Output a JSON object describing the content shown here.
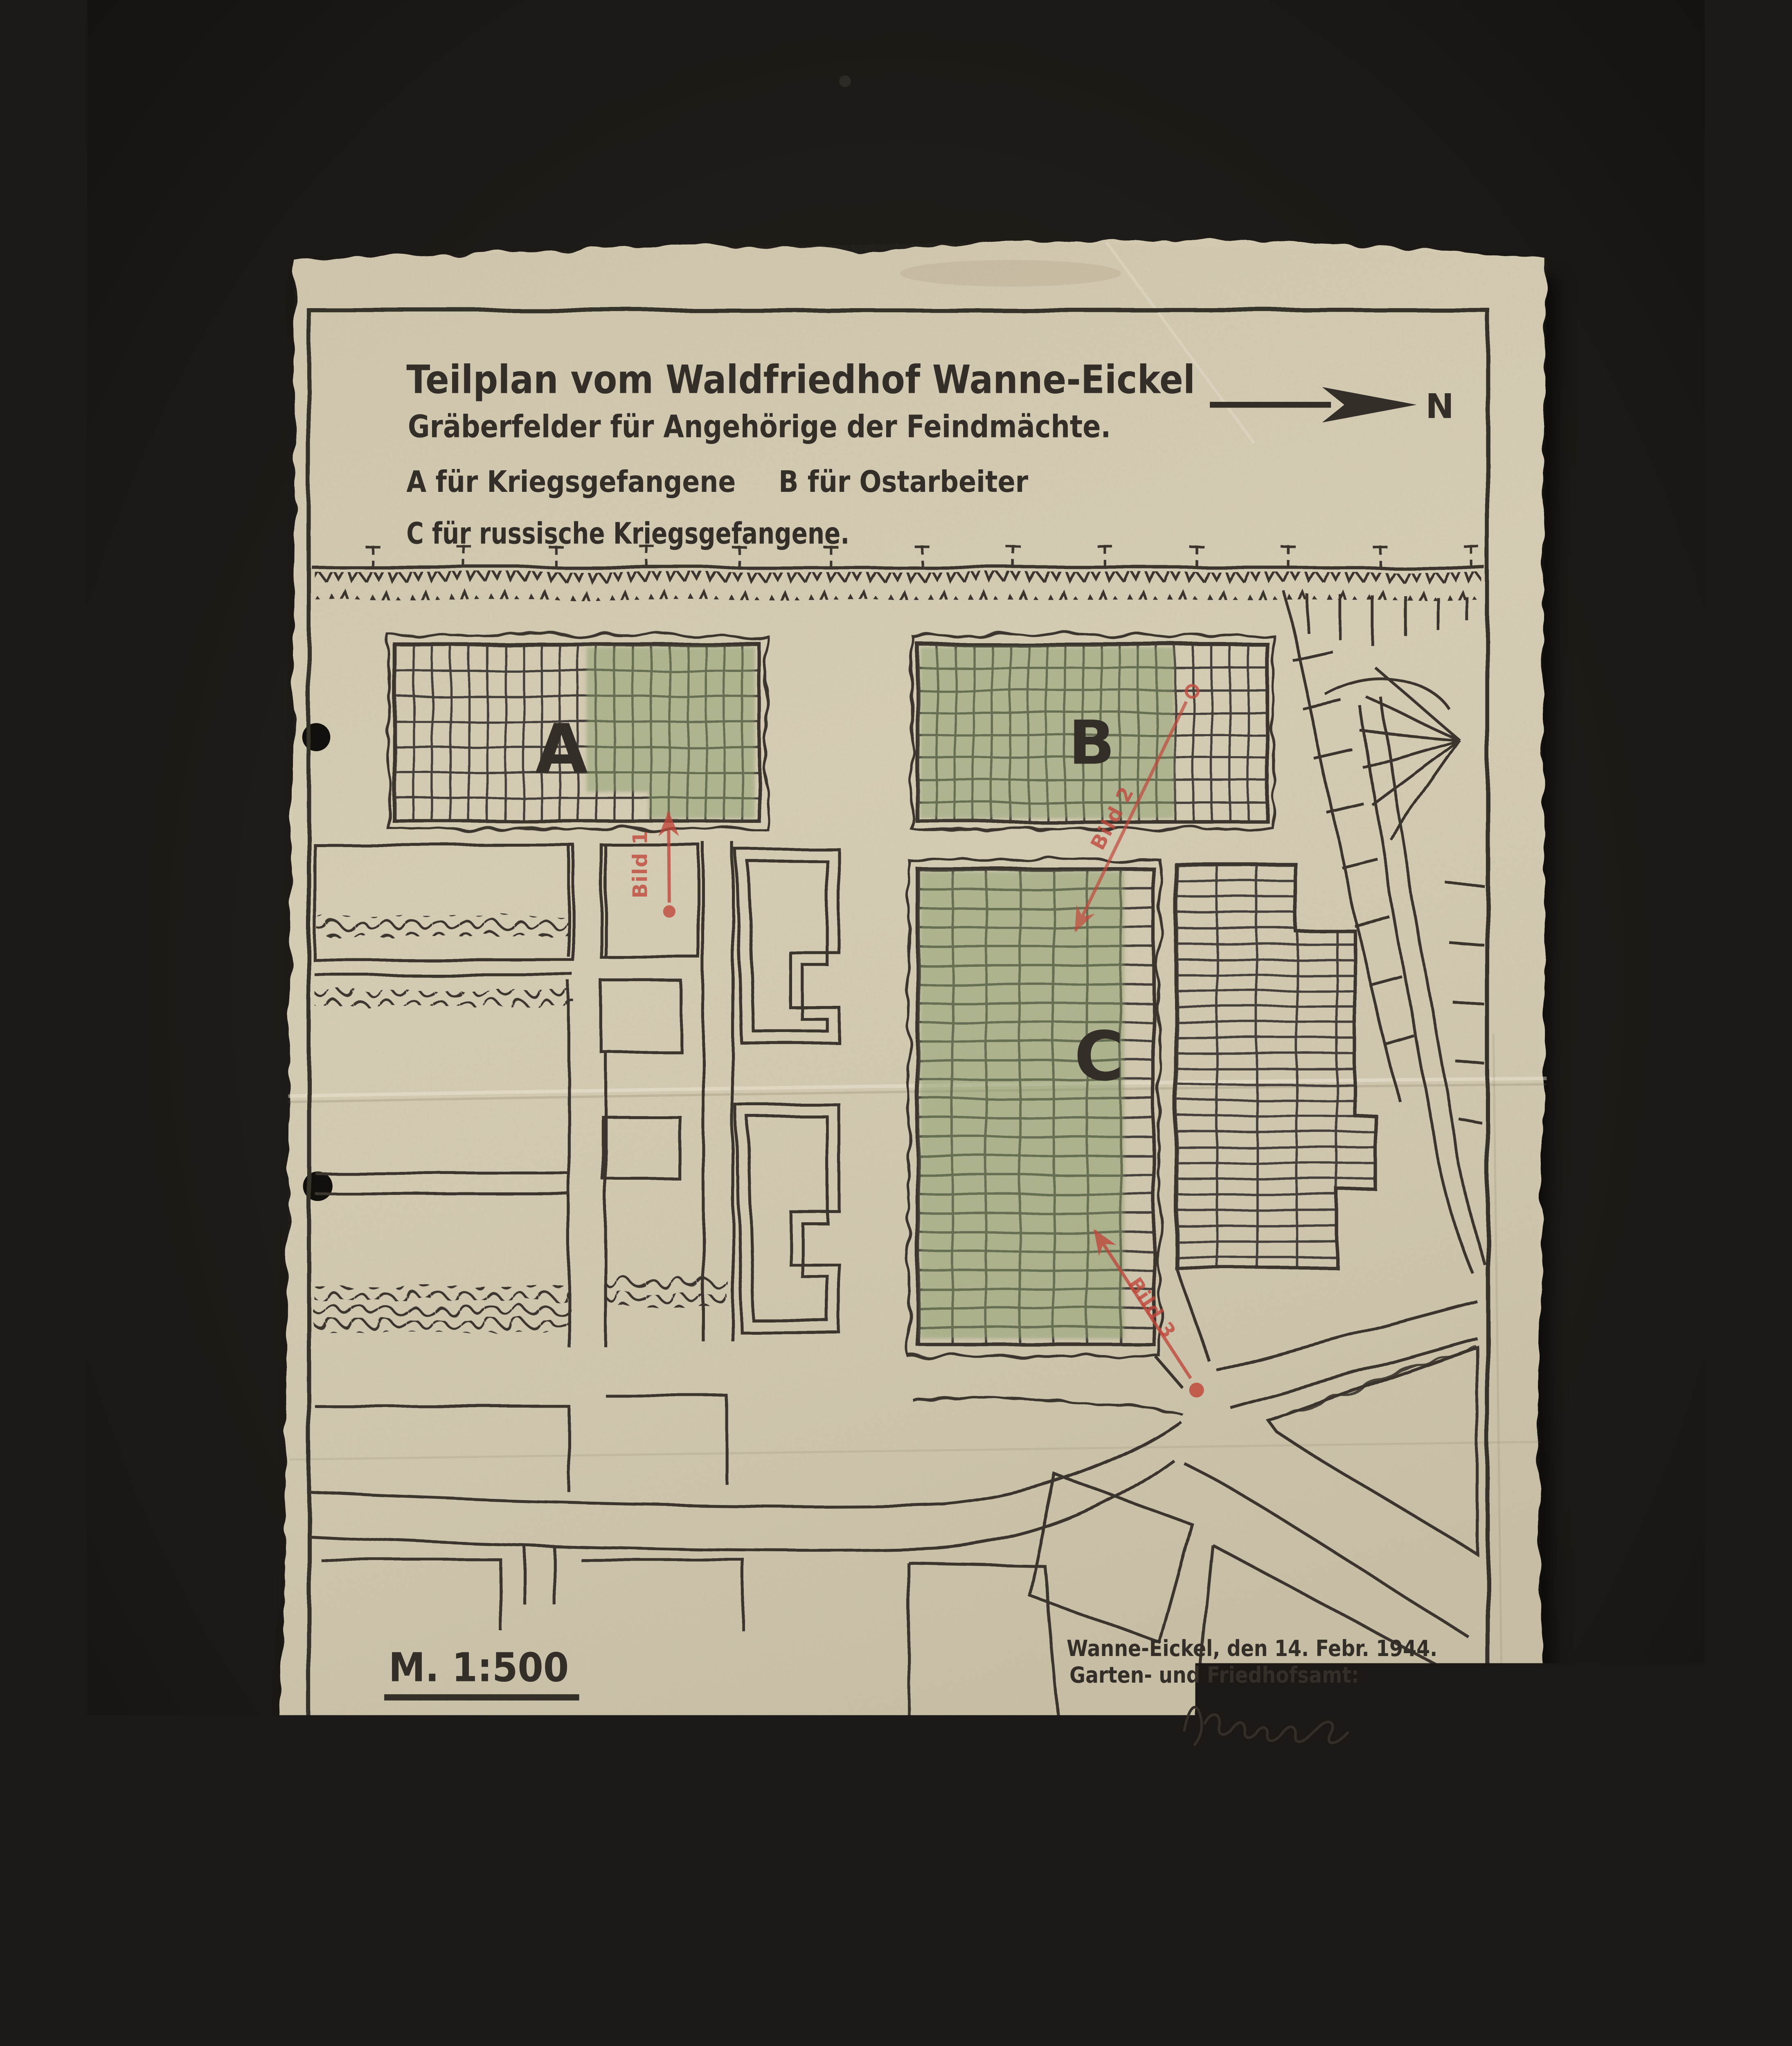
{
  "scan": {
    "background_color": "#1b1815",
    "paper_color": "#d2c9b1"
  },
  "header": {
    "title": "Teilplan vom Waldfriedhof Wanne-Eickel",
    "subtitle": "Gräberfelder für Angehörige der Feindmächte.",
    "legend": [
      {
        "field": "A",
        "text": "A für Kriegsgefangene"
      },
      {
        "field": "B",
        "text": "B für Ostarbeiter"
      },
      {
        "field": "C",
        "text": "C für russische Kriegsgefangene."
      }
    ]
  },
  "compass": {
    "direction_label": "N"
  },
  "map": {
    "field_labels": {
      "a": "A",
      "b": "B",
      "c": "C"
    },
    "photo_marks": [
      {
        "label": "Bild 1"
      },
      {
        "label": "Bild 2"
      },
      {
        "label": "Bild 3"
      }
    ],
    "green_color": "#8a9e6d",
    "ink_color": "#3a352e",
    "red_color": "#c0493c"
  },
  "footer": {
    "scale_label": "M. 1:500",
    "place_date": "Wanne-Eickel, den 14. Febr. 1944.",
    "office": "Garten- und Friedhofsamt:"
  }
}
